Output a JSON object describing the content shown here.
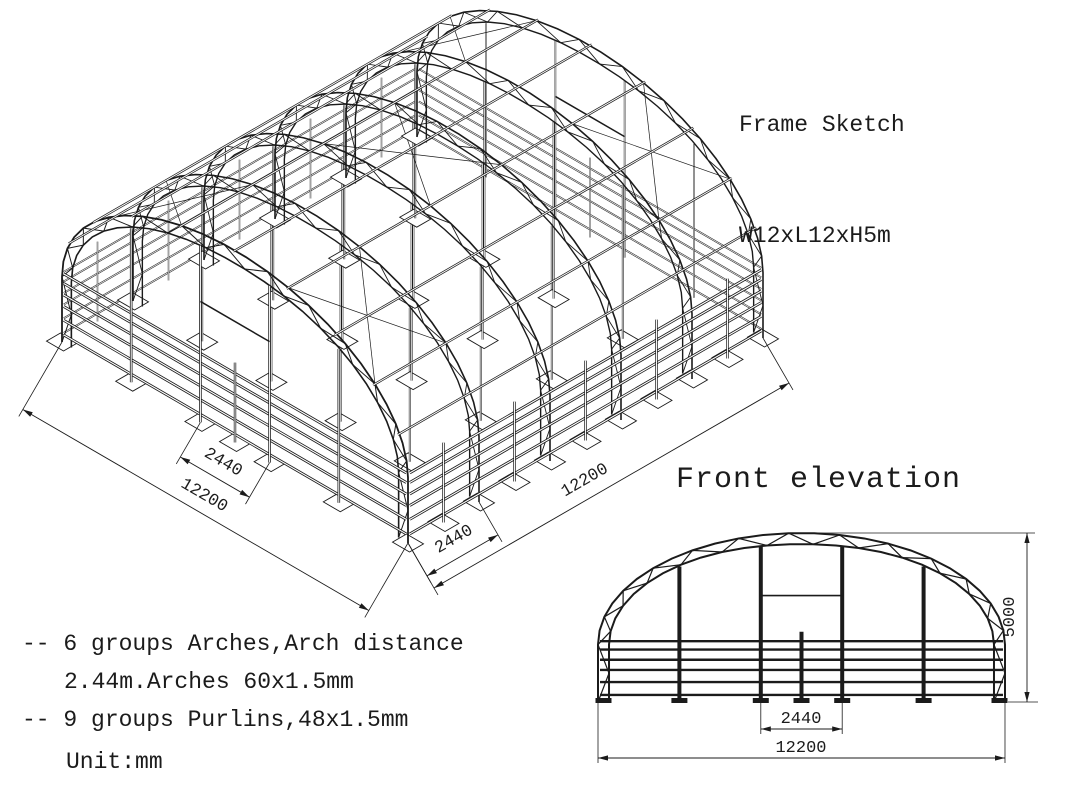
{
  "title": {
    "line1": "Frame Sketch",
    "line2": "W12xL12xH5m"
  },
  "isometric": {
    "dim_span_total": "12200",
    "dim_span_door": "2440",
    "dim_length_total": "12200",
    "dim_length_bay": "2440"
  },
  "elevation": {
    "label": "Front elevation",
    "dim_height": "5000",
    "dim_door_width": "2440",
    "dim_total_width": "12200"
  },
  "notes": {
    "line1": "-- 6 groups Arches,Arch distance",
    "line2": "2.44m.Arches 60x1.5mm",
    "line3": "-- 9 groups Purlins,48x1.5mm",
    "line4": "Unit:mm"
  },
  "specs": {
    "width_m": 12,
    "length_m": 12,
    "height_m": 5,
    "arch_groups": 6,
    "arch_distance_m": 2.44,
    "arch_tube": "60x1.5mm",
    "purlin_groups": 9,
    "purlin_tube": "48x1.5mm",
    "unit": "mm"
  },
  "colors": {
    "line": "#1b1b1b",
    "background": "#ffffff"
  }
}
